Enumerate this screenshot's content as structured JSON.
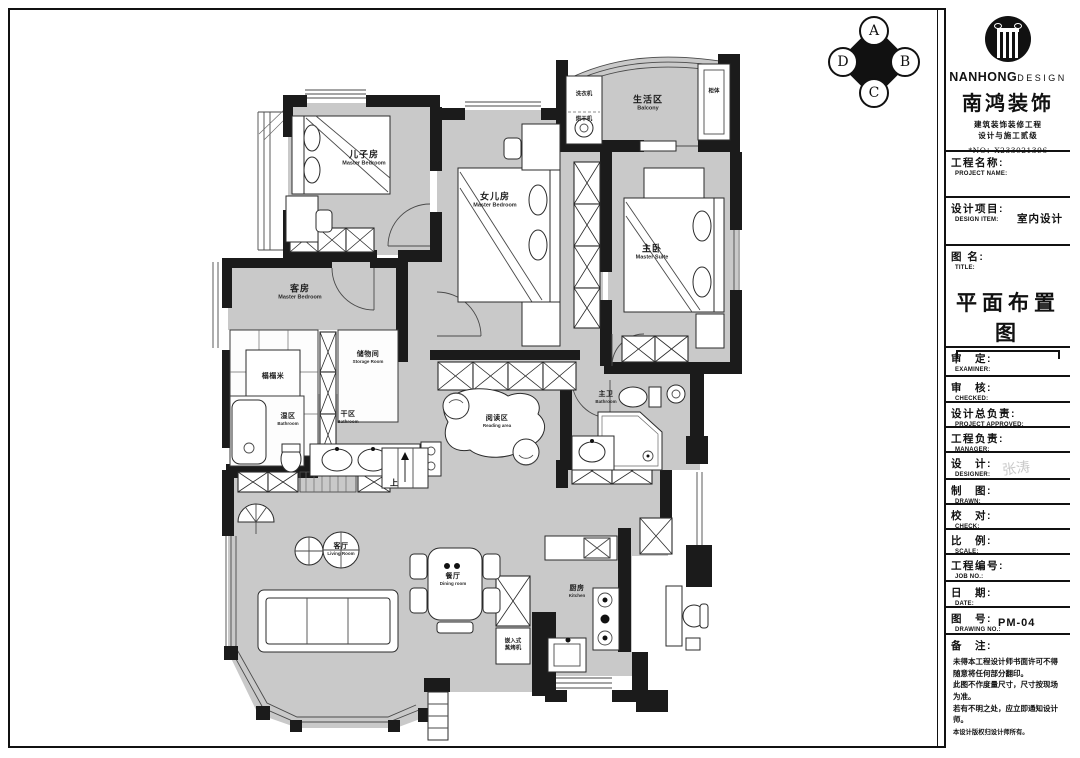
{
  "titleblock": {
    "brand": {
      "name_en_bold": "NANHONG",
      "name_en_light": "DESIGN",
      "name_cn": "南鸿装饰",
      "cert_line1": "建筑装饰装修工程",
      "cert_line2": "设计与施工贰级",
      "no_line": "*NO：X233021396"
    },
    "project_name": {
      "cn": "工程名称:",
      "en": "PROJECT NAME:"
    },
    "design_item": {
      "cn": "设计项目:",
      "en": "DESIGN ITEM:",
      "value": "室内设计"
    },
    "drawing_title": {
      "cn": "图 名:",
      "en": "TITLE:",
      "value": "平面布置图"
    },
    "examiner": {
      "cn": "审　定:",
      "en": "EXAMINER:"
    },
    "checked": {
      "cn": "审　核:",
      "en": "CHECKED:"
    },
    "project_approved": {
      "cn": "设计总负责:",
      "en": "PROJECT APPROVED:"
    },
    "manager": {
      "cn": "工程负责:",
      "en": "MANAGER:"
    },
    "designer": {
      "cn": "设　计:",
      "en": "DESIGNER:",
      "value": "张涛"
    },
    "drawn": {
      "cn": "制　图:",
      "en": "DRAWN:"
    },
    "check": {
      "cn": "校　对:",
      "en": "CHECK:"
    },
    "scale": {
      "cn": "比　例:",
      "en": "SCALE:"
    },
    "job_no": {
      "cn": "工程编号:",
      "en": "JOB  NO.:"
    },
    "date": {
      "cn": "日　期:",
      "en": "DATE:"
    },
    "drawing_no": {
      "cn": "图　号:",
      "en": "DRAWING NO.:",
      "value": "PM-04"
    },
    "remarks": {
      "cn": "备　注:",
      "lines": [
        "未得本工程设计师书面许可不得随意将任何部分翻印。",
        "此图不作度量尺寸，尺寸按现场为准。",
        "若有不明之处，应立即通知设计师。",
        "本设计版权归设计师所有。"
      ]
    }
  },
  "compass": {
    "a": "A",
    "b": "B",
    "c": "C",
    "d": "D"
  },
  "plan": {
    "rooms": {
      "son": {
        "cn": "儿子房",
        "en": "Master Bedroom"
      },
      "daughter": {
        "cn": "女儿房",
        "en": "Master Bedroom"
      },
      "master": {
        "cn": "主卧",
        "en": "Master Suite"
      },
      "balcony": {
        "cn": "生活区",
        "en": "Balcony"
      },
      "guest": {
        "cn": "客房",
        "en": "Master Bedroom"
      },
      "tatami": {
        "cn": "榻榻米",
        "en": ""
      },
      "storage": {
        "cn": "储物间",
        "en": "Storage Room"
      },
      "wet_bath": {
        "cn": "湿区",
        "en": "Bathroom"
      },
      "dry_bath": {
        "cn": "干区",
        "en": "Bathroom"
      },
      "reading": {
        "cn": "阅读区",
        "en": "Reading area"
      },
      "master_bath": {
        "cn": "主卫",
        "en": "Bathroom"
      },
      "living": {
        "cn": "客厅",
        "en": "Living Room"
      },
      "dining": {
        "cn": "餐厅",
        "en": "Dining room"
      },
      "kitchen": {
        "cn": "厨房",
        "en": "Kitchen"
      },
      "oven": {
        "line1": "嵌入式",
        "line2": "蒸烤机"
      },
      "laundry": {
        "cn": "洗衣机"
      },
      "dryer": {
        "cn": "烘干机"
      },
      "cabinet": {
        "cn": "柜体"
      },
      "up": "上"
    }
  }
}
